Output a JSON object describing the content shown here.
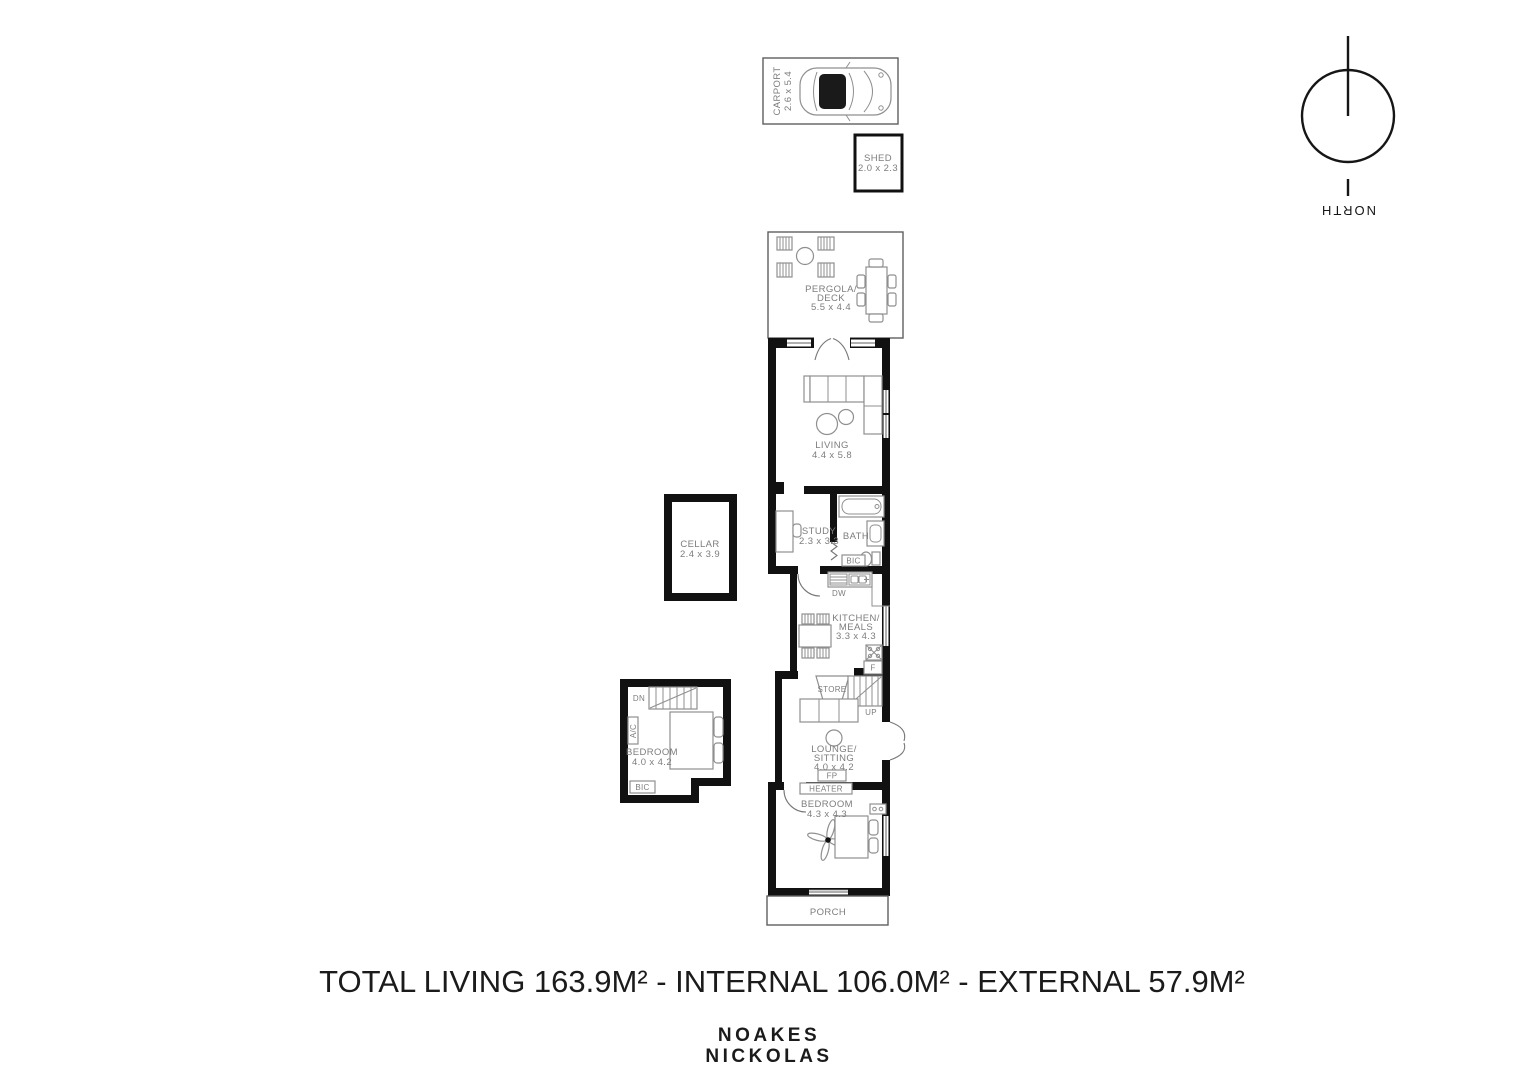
{
  "footer": {
    "title": "TOTAL LIVING 163.9M² - INTERNAL 106.0M² - EXTERNAL 57.9M²",
    "brand_line1": "NOAKES",
    "brand_line2": "NICKOLAS"
  },
  "compass": {
    "label": "NORTH"
  },
  "rooms": {
    "carport": {
      "name": "CARPORT",
      "dims": "2.6 x 5.4"
    },
    "shed": {
      "name": "SHED",
      "dims": "2.0 x 2.3"
    },
    "pergola": {
      "line1": "PERGOLA/",
      "line2": "DECK",
      "dims": "5.5 x 4.4"
    },
    "living": {
      "name": "LIVING",
      "dims": "4.4 x 5.8"
    },
    "study": {
      "name": "STUDY",
      "dims": "2.3 x 3.3"
    },
    "bath": {
      "name": "BATH"
    },
    "kitchen": {
      "line1": "KITCHEN/",
      "line2": "MEALS",
      "dims": "3.3 x 4.3"
    },
    "cellar": {
      "name": "CELLAR",
      "dims": "2.4 x 3.9"
    },
    "bedroom_rear": {
      "name": "BEDROOM",
      "dims": "4.0 x 4.2"
    },
    "lounge": {
      "line1": "LOUNGE/",
      "line2": "SITTING",
      "dims": "4.0 x 4.2"
    },
    "bedroom_front": {
      "name": "BEDROOM",
      "dims": "4.3 x 4.3"
    },
    "porch": {
      "name": "PORCH"
    },
    "store": {
      "name": "STORE"
    }
  },
  "fixtures": {
    "dw": "DW",
    "bic": "BIC",
    "fridge": "F",
    "fireplace": "FP",
    "heater": "HEATER",
    "ac": "A/C",
    "up": "UP",
    "dn": "DN"
  }
}
